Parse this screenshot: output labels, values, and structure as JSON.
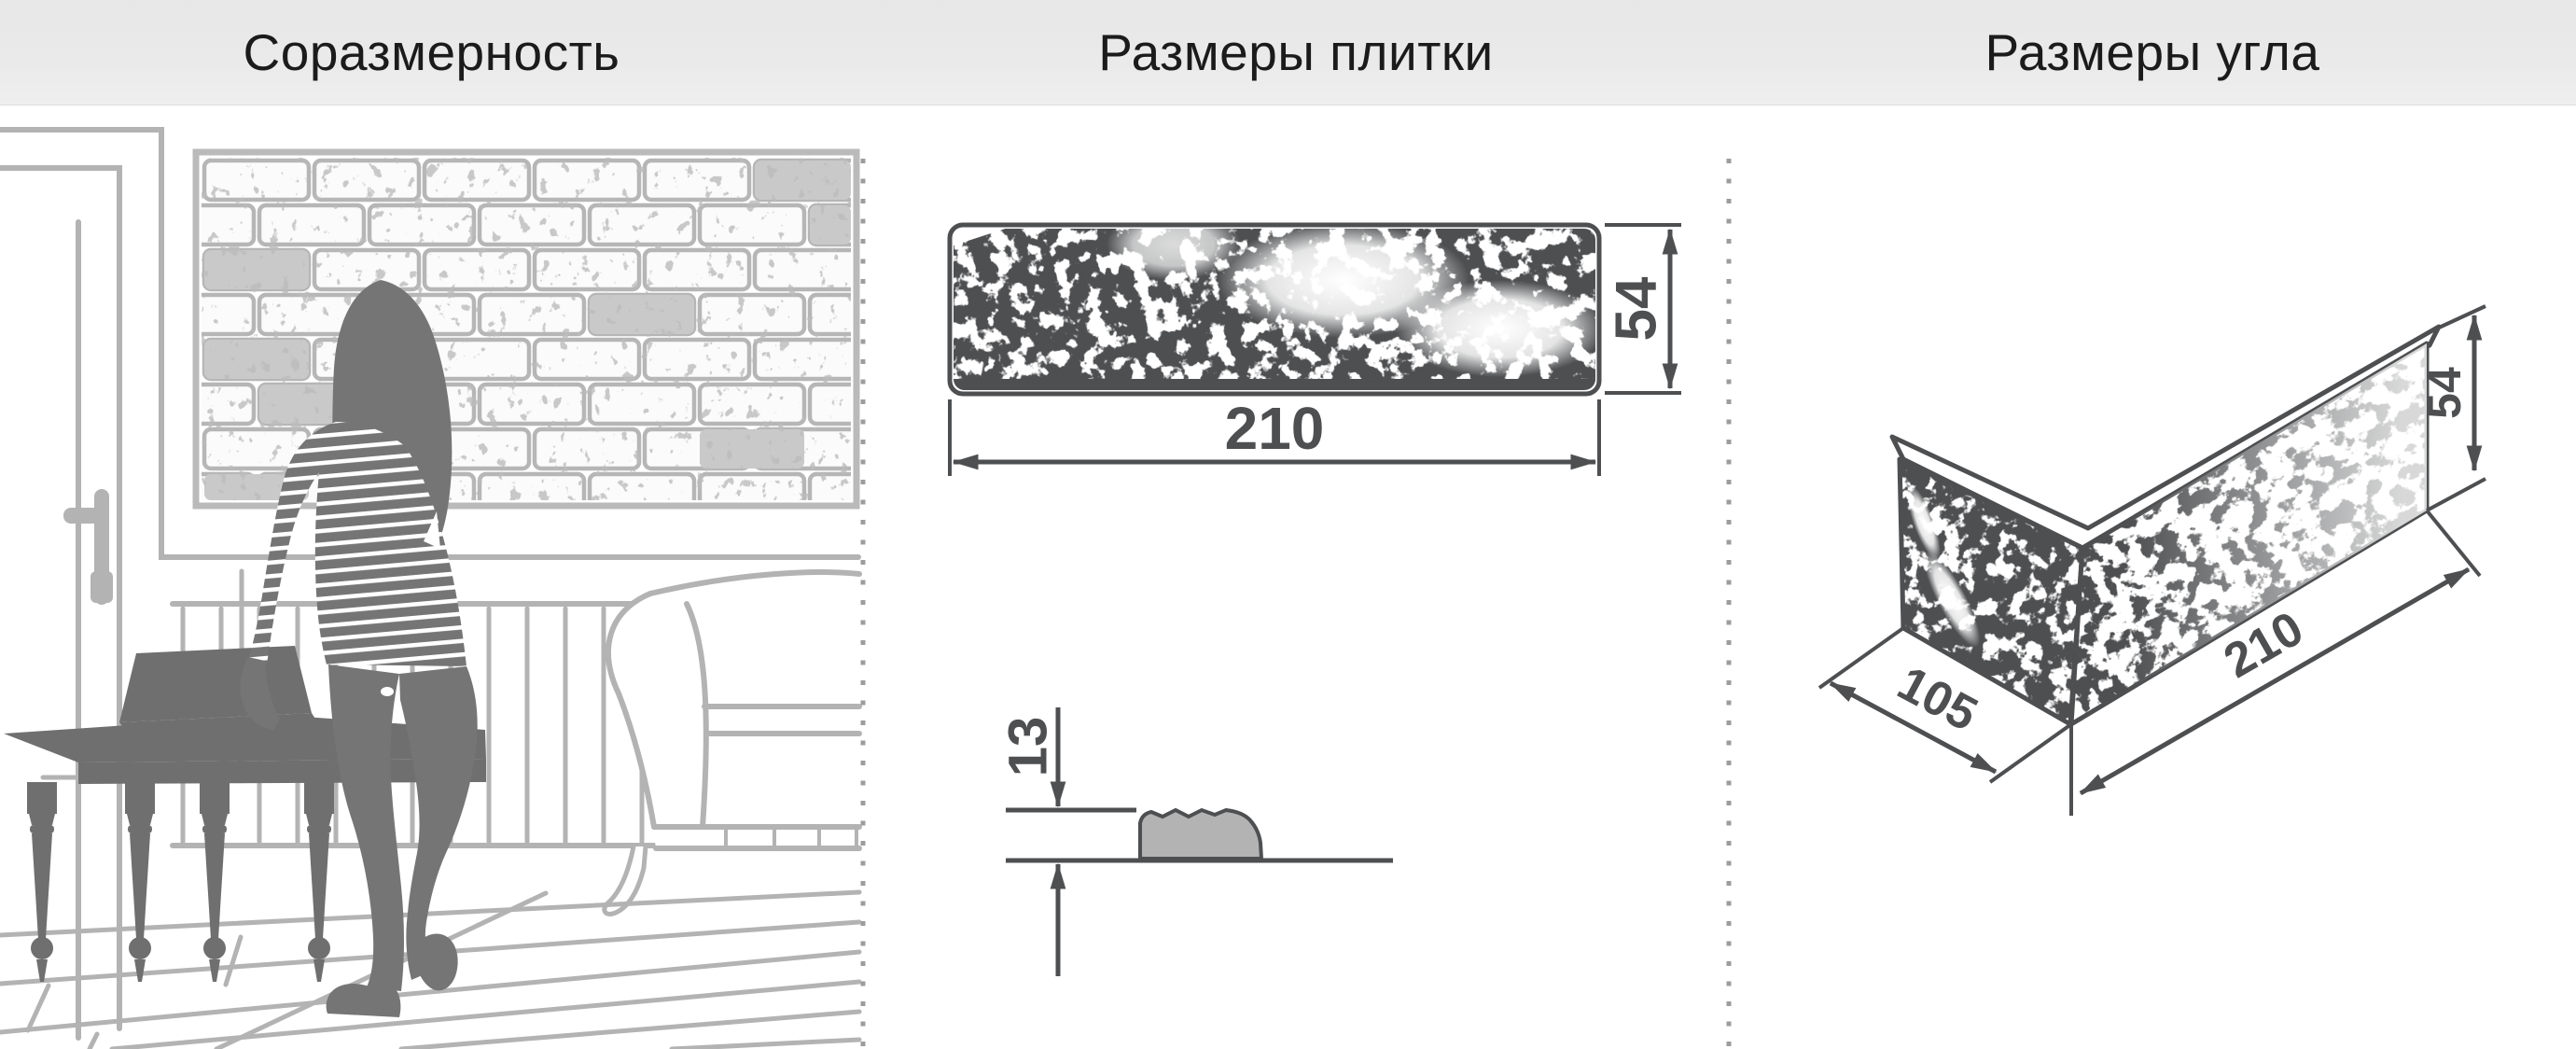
{
  "panels": {
    "proportion": {
      "title": "Соразмерность"
    },
    "tile": {
      "title": "Размеры плитки",
      "front": {
        "width": "210",
        "height": "54"
      },
      "side": {
        "thickness": "13"
      }
    },
    "corner": {
      "title": "Размеры угла",
      "depth": "105",
      "length": "210",
      "height": "54"
    }
  },
  "colors": {
    "header_bg": "#e9e9e9",
    "dimension_lines": "#4e4f51",
    "room_outline": "#b3b3b3",
    "silhouette": "#757575",
    "furniture_silhouette": "#6f6f6f",
    "divider_dots": "#9c9c9c",
    "tile_side_fill": "#b3b3b3"
  }
}
